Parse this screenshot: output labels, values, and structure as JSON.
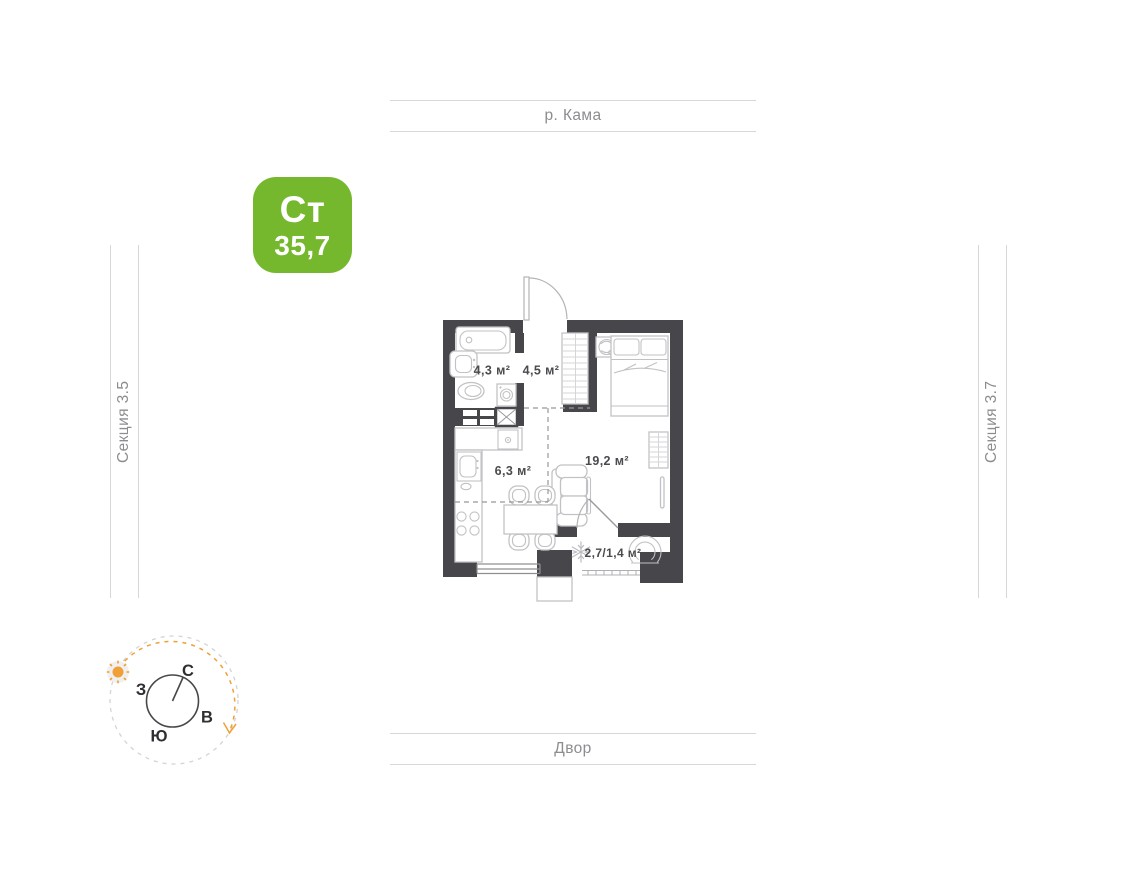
{
  "context": {
    "top": {
      "label": "р. Кама"
    },
    "bottom": {
      "label": "Двор"
    },
    "left": {
      "label": "Секция 3.5"
    },
    "right": {
      "label": "Секция 3.7"
    }
  },
  "badge": {
    "type": "Ст",
    "area": "35,7"
  },
  "plan": {
    "rooms": [
      {
        "name": "bathroom",
        "area": "4,3 м²"
      },
      {
        "name": "hallway",
        "area": "4,5 м²"
      },
      {
        "name": "kitchen",
        "area": "6,3 м²"
      },
      {
        "name": "living-room",
        "area": "19,2 м²"
      },
      {
        "name": "balcony",
        "area": "2,7/1,4 м²"
      }
    ]
  },
  "compass": {
    "north": "С",
    "east": "В",
    "south": "Ю",
    "west": "З"
  },
  "colors": {
    "accent_green": "#76b82d",
    "accent_orange": "#f0a035",
    "wall": "#47474b",
    "furniture_line": "#c2c2c6",
    "context_text": "#8d8d91",
    "room_label": "#4b4b4f"
  }
}
